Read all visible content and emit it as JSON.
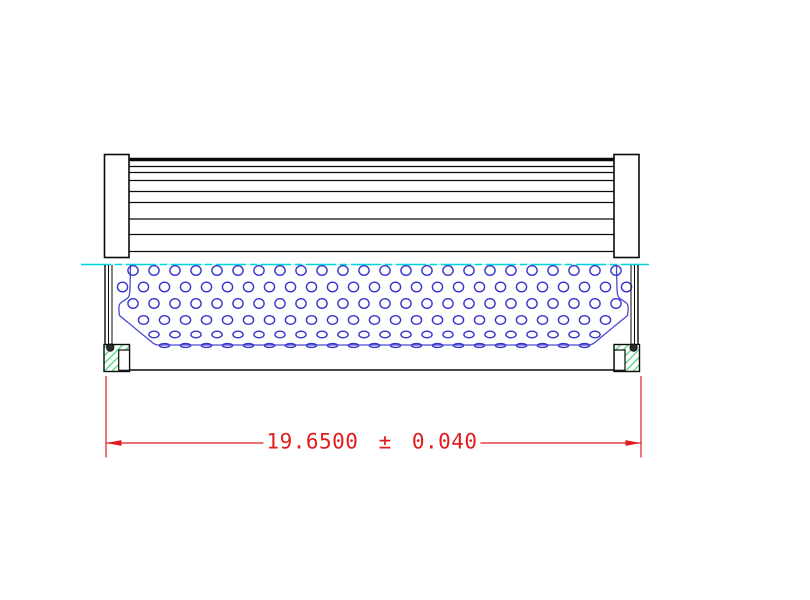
{
  "drawing": {
    "title": "filter-element-cross-section-drawing",
    "canvas": {
      "width": 810,
      "height": 600,
      "background": "#ffffff"
    },
    "colors": {
      "line": "#0a0a0a",
      "core_blue": "#3434cb",
      "outline_blue": "#4a4ad2",
      "centerline_cyan": "#00d6dc",
      "centerline_pale": "#b5eef0",
      "hatch_green": "#4cd974",
      "oring_fill": "#2f2f2f",
      "dimension_red": "#e11d1d"
    },
    "dimension": {
      "label": "19.6500 ± 0.040",
      "value": "19.6500",
      "tolerance": "0.040"
    },
    "shapes": [
      {
        "name": "left-end-cap",
        "type": "rect",
        "x": 104.5,
        "y": 154.5,
        "w": 24.5,
        "h": 103,
        "fill": "#ffffff",
        "stroke": "line",
        "sw": 1.6
      },
      {
        "name": "right-end-cap",
        "type": "rect",
        "x": 614,
        "y": 154.5,
        "w": 25,
        "h": 103,
        "fill": "#ffffff",
        "stroke": "line",
        "sw": 1.6
      },
      {
        "name": "pleat-top-edge",
        "type": "line",
        "x1": 129,
        "y1": 159.5,
        "x2": 614,
        "y2": 159.5,
        "stroke": "line",
        "sw": 3.4
      },
      {
        "name": "pleat-lines",
        "type": "hlines",
        "x1": 129,
        "x2": 614,
        "ys": [
          166.5,
          172.5,
          180.5,
          191.5,
          202.5,
          219,
          234.5,
          251.5
        ],
        "stroke": "line",
        "sw": 1.3
      },
      {
        "name": "centerline-underlay",
        "type": "line",
        "x1": 81,
        "y1": 264.5,
        "x2": 649,
        "y2": 264.5,
        "stroke": "centerline_pale",
        "sw": 1.3
      },
      {
        "name": "centerline",
        "type": "line",
        "x1": 81,
        "y1": 264.5,
        "x2": 649,
        "y2": 264.5,
        "stroke": "centerline_cyan",
        "sw": 1.5,
        "dash": "30 4 7 4"
      },
      {
        "name": "core-tube-outline",
        "type": "path",
        "d": "M130.5,265 C130,285 130.5,294 128.5,297 C126.5,300 121,301.5 119.5,304.5 C118.5,306.5 119,312 119.5,315.5 L153.5,343.5 L157,345 L590,345 L593.5,343.5 L627.5,315.5 C628,312 628.5,306.5 627.5,304.5 C626,301.5 620.5,300 618.5,297 C616.5,294 617,285 616.5,265",
        "stroke": "outline_blue",
        "sw": 1.3,
        "fill": "none"
      },
      {
        "name": "core-perforations",
        "type": "perforations"
      },
      {
        "name": "left-wall-outer",
        "type": "line",
        "x1": 105,
        "y1": 265,
        "x2": 105,
        "y2": 344.5,
        "stroke": "line",
        "sw": 1.4
      },
      {
        "name": "left-wall-mid",
        "type": "line",
        "x1": 108.5,
        "y1": 265,
        "x2": 108.5,
        "y2": 344.5,
        "stroke": "line",
        "sw": 1
      },
      {
        "name": "left-wall-inner",
        "type": "line",
        "x1": 112,
        "y1": 265,
        "x2": 112,
        "y2": 344.5,
        "stroke": "line",
        "sw": 1
      },
      {
        "name": "right-wall-outer",
        "type": "line",
        "x1": 638,
        "y1": 265,
        "x2": 638,
        "y2": 344.5,
        "stroke": "line",
        "sw": 1.4
      },
      {
        "name": "right-wall-mid",
        "type": "line",
        "x1": 634.5,
        "y1": 265,
        "x2": 634.5,
        "y2": 344.5,
        "stroke": "line",
        "sw": 1
      },
      {
        "name": "right-wall-inner",
        "type": "line",
        "x1": 631,
        "y1": 265,
        "x2": 631,
        "y2": 344.5,
        "stroke": "line",
        "sw": 1
      },
      {
        "name": "bottom-plate-edge",
        "type": "line",
        "x1": 104,
        "y1": 370,
        "x2": 639.5,
        "y2": 370,
        "stroke": "line",
        "sw": 1.4
      },
      {
        "name": "left-seal-block",
        "type": "rect",
        "x": 104,
        "y": 344.5,
        "w": 25.5,
        "h": 27,
        "fill": "hatch",
        "stroke": "line",
        "sw": 1.4
      },
      {
        "name": "right-seal-block",
        "type": "rect",
        "x": 614,
        "y": 344.5,
        "w": 25.5,
        "h": 27,
        "fill": "hatch",
        "stroke": "line",
        "sw": 1.4
      },
      {
        "name": "left-seal-notch",
        "type": "rect",
        "x": 118.7,
        "y": 350,
        "w": 10.8,
        "h": 20.3,
        "fill": "#ffffff",
        "stroke": "line",
        "sw": 1.2
      },
      {
        "name": "right-seal-notch",
        "type": "rect",
        "x": 614.2,
        "y": 350,
        "w": 10.8,
        "h": 20.3,
        "fill": "#ffffff",
        "stroke": "line",
        "sw": 1.2
      },
      {
        "name": "left-oring",
        "type": "circle",
        "cx": 110.2,
        "cy": 347.6,
        "r": 3.6,
        "fill": "oring_fill",
        "stroke": "line",
        "sw": 1
      },
      {
        "name": "right-oring",
        "type": "circle",
        "cx": 633.6,
        "cy": 347.6,
        "r": 3.6,
        "fill": "oring_fill",
        "stroke": "line",
        "sw": 1
      },
      {
        "name": "left-extension-line",
        "type": "line",
        "x1": 106,
        "y1": 376,
        "x2": 106,
        "y2": 457.5,
        "stroke": "dimension_red",
        "sw": 1.2
      },
      {
        "name": "right-extension-line",
        "type": "line",
        "x1": 641,
        "y1": 376,
        "x2": 641,
        "y2": 457.5,
        "stroke": "dimension_red",
        "sw": 1.2
      },
      {
        "name": "dimension-line-left",
        "type": "line",
        "x1": 106,
        "y1": 443,
        "x2": 272,
        "y2": 443,
        "stroke": "dimension_red",
        "sw": 1.2
      },
      {
        "name": "dimension-line-right",
        "type": "line",
        "x1": 473,
        "y1": 443,
        "x2": 641,
        "y2": 443,
        "stroke": "dimension_red",
        "sw": 1.2
      },
      {
        "name": "left-arrowhead",
        "type": "polygon",
        "points": "106,443 121.5,440.1 121.5,445.9",
        "fill": "dimension_red"
      },
      {
        "name": "right-arrowhead",
        "type": "polygon",
        "points": "641,443 625.5,440.1 625.5,445.9",
        "fill": "dimension_red"
      }
    ],
    "perforations": {
      "rx": 5.1,
      "spacing": 21,
      "stroke": "core_blue",
      "sw": 1.4,
      "rows": [
        {
          "cy": 270.5,
          "ry": 4.8,
          "x0": 133,
          "x1": 620
        },
        {
          "cy": 287,
          "ry": 4.8,
          "x0": 122.5,
          "x1": 630
        },
        {
          "cy": 303.5,
          "ry": 4.8,
          "x0": 133,
          "x1": 620
        },
        {
          "cy": 320,
          "ry": 4.3,
          "x0": 143.5,
          "x1": 612
        },
        {
          "cy": 334.5,
          "ry": 3.3,
          "x0": 154,
          "x1": 601
        },
        {
          "cy": 345.5,
          "ry": 1.9,
          "x0": 164.5,
          "x1": 591
        }
      ]
    }
  }
}
